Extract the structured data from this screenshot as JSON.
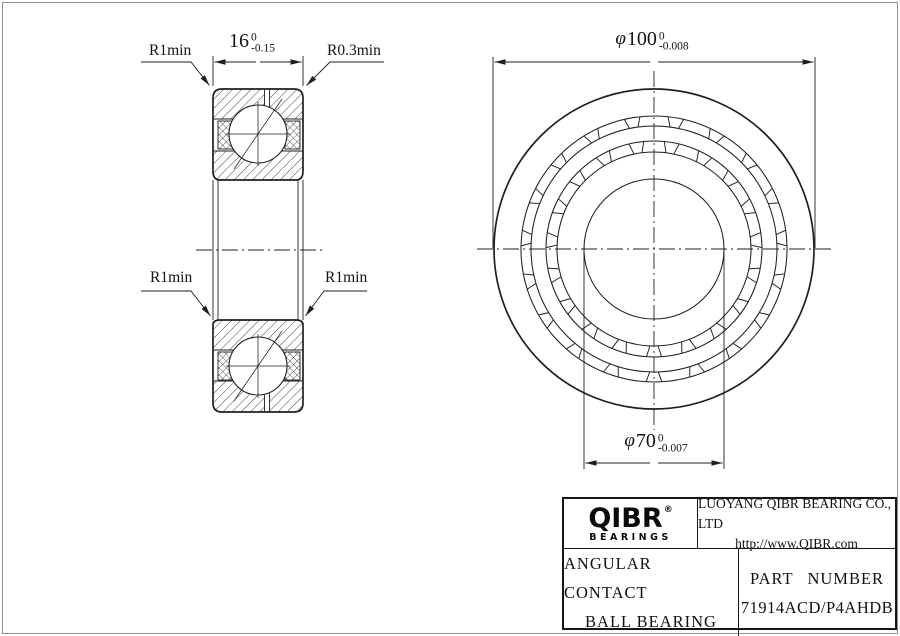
{
  "page": {
    "background": "#ffffff",
    "line_color": "#1f1f1f",
    "border_color": "#8f8f8f"
  },
  "section_view": {
    "dim_width": {
      "value": "16",
      "tol_upper": "0",
      "tol_lower": "-0.15"
    },
    "labels": {
      "radius_top_left": "R1min",
      "radius_top_right": "R0.3min",
      "radius_mid_left": "R1min",
      "radius_mid_right": "R1min"
    }
  },
  "front_view": {
    "dim_outer": {
      "symbol": "φ",
      "value": "100",
      "tol_upper": "0",
      "tol_lower": "-0.008"
    },
    "dim_bore": {
      "symbol": "φ",
      "value": "70",
      "tol_upper": "0",
      "tol_lower": "-0.007"
    },
    "cage_bar_count": 19
  },
  "title_block": {
    "logo": {
      "brand": "QIBR",
      "registered": "®",
      "sub": "BEARINGS"
    },
    "company": "LUOYANG QIBR BEARING CO., LTD",
    "website": "http://www.QIBR.com",
    "product_line1": "ANGULAR CONTACT",
    "product_line2": "BALL BEARING",
    "part_number_label": "PART NUMBER",
    "part_number": "71914ACD/P4AHDB"
  }
}
